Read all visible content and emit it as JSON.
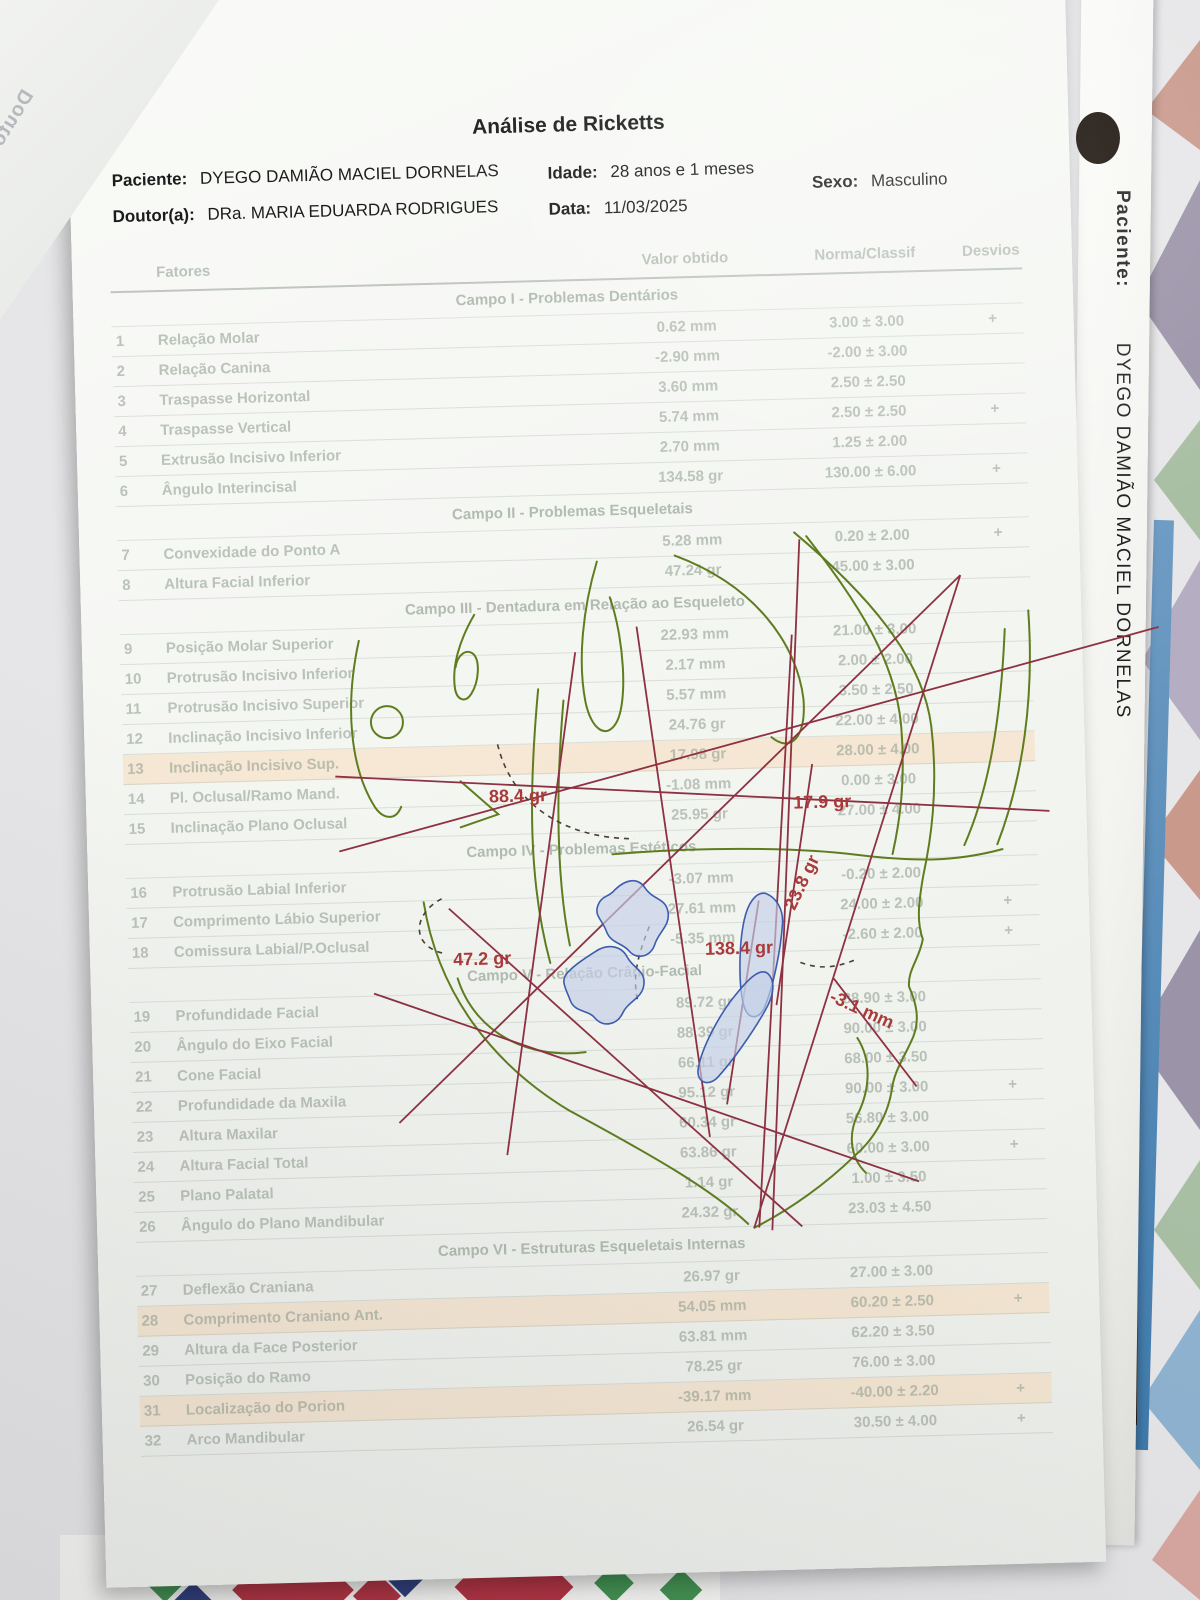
{
  "document": {
    "title": "Análise de Ricketts",
    "patient_label": "Paciente:",
    "patient_name": "DYEGO DAMIÃO MACIEL DORNELAS",
    "doctor_label": "Doutor(a):",
    "doctor_name": "DRa. MARIA EDUARDA RODRIGUES",
    "age_label": "Idade:",
    "age_value": "28 anos e 1 meses",
    "date_label": "Data:",
    "date_value": "11/03/2025",
    "sex_label": "Sexo:",
    "sex_value": "Masculino"
  },
  "table": {
    "columns": [
      "Fatores",
      "Valor obtido",
      "Norma/Classif",
      "Desvios"
    ],
    "sections": [
      {
        "title": "Campo I - Problemas Dentários",
        "rows": [
          {
            "num": "1",
            "factor": "Relação Molar",
            "value": "0.62 mm",
            "norm": "3.00 ± 3.00",
            "dev": "+"
          },
          {
            "num": "2",
            "factor": "Relação Canina",
            "value": "-2.90 mm",
            "norm": "-2.00 ± 3.00",
            "dev": ""
          },
          {
            "num": "3",
            "factor": "Traspasse Horizontal",
            "value": "3.60 mm",
            "norm": "2.50 ± 2.50",
            "dev": ""
          },
          {
            "num": "4",
            "factor": "Traspasse Vertical",
            "value": "5.74 mm",
            "norm": "2.50 ± 2.50",
            "dev": "+"
          },
          {
            "num": "5",
            "factor": "Extrusão Incisivo Inferior",
            "value": "2.70 mm",
            "norm": "1.25 ± 2.00",
            "dev": ""
          },
          {
            "num": "6",
            "factor": "Ângulo Interincisal",
            "value": "134.58 gr",
            "norm": "130.00 ± 6.00",
            "dev": "+"
          }
        ]
      },
      {
        "title": "Campo II - Problemas Esqueletais",
        "rows": [
          {
            "num": "7",
            "factor": "Convexidade do Ponto A",
            "value": "5.28 mm",
            "norm": "0.20 ± 2.00",
            "dev": "+"
          },
          {
            "num": "8",
            "factor": "Altura Facial Inferior",
            "value": "47.24 gr",
            "norm": "45.00 ± 3.00",
            "dev": ""
          }
        ]
      },
      {
        "title": "Campo III - Dentadura em Relação ao Esqueleto",
        "rows": [
          {
            "num": "9",
            "factor": "Posição Molar Superior",
            "value": "22.93 mm",
            "norm": "21.00 ± 3.00",
            "dev": ""
          },
          {
            "num": "10",
            "factor": "Protrusão Incisivo Inferior",
            "value": "2.17 mm",
            "norm": "2.00 ± 2.00",
            "dev": ""
          },
          {
            "num": "11",
            "factor": "Protrusão Incisivo Superior",
            "value": "5.57 mm",
            "norm": "3.50 ± 2.50",
            "dev": ""
          },
          {
            "num": "12",
            "factor": "Inclinação Incisivo Inferior",
            "value": "24.76 gr",
            "norm": "22.00 ± 4.00",
            "dev": ""
          },
          {
            "num": "13",
            "factor": "Inclinação Incisivo Sup.",
            "value": "17.98 gr",
            "norm": "28.00 ± 4.00",
            "dev": "",
            "hl": true
          },
          {
            "num": "14",
            "factor": "Pl. Oclusal/Ramo Mand.",
            "value": "-1.08 mm",
            "norm": "0.00 ± 3.00",
            "dev": ""
          },
          {
            "num": "15",
            "factor": "Inclinação Plano Oclusal",
            "value": "25.95 gr",
            "norm": "27.00 ± 4.00",
            "dev": ""
          }
        ]
      },
      {
        "title": "Campo IV - Problemas Estéticos",
        "rows": [
          {
            "num": "16",
            "factor": "Protrusão Labial Inferior",
            "value": "-3.07 mm",
            "norm": "-0.20 ± 2.00",
            "dev": ""
          },
          {
            "num": "17",
            "factor": "Comprimento Lábio Superior",
            "value": "27.61 mm",
            "norm": "24.00 ± 2.00",
            "dev": "+"
          },
          {
            "num": "18",
            "factor": "Comissura Labial/P.Oclusal",
            "value": "-5.35 mm",
            "norm": "-2.60 ± 2.00",
            "dev": "+"
          }
        ]
      },
      {
        "title": "Campo V - Relação Crânio-Facial",
        "rows": [
          {
            "num": "19",
            "factor": "Profundidade Facial",
            "value": "89.72 gr",
            "norm": "88.90 ± 3.00",
            "dev": ""
          },
          {
            "num": "20",
            "factor": "Ângulo do Eixo Facial",
            "value": "88.39 gr",
            "norm": "90.00 ± 3.00",
            "dev": ""
          },
          {
            "num": "21",
            "factor": "Cone Facial",
            "value": "66.11 gr",
            "norm": "68.00 ± 3.50",
            "dev": ""
          },
          {
            "num": "22",
            "factor": "Profundidade da Maxila",
            "value": "95.12 gr",
            "norm": "90.00 ± 3.00",
            "dev": "+"
          },
          {
            "num": "23",
            "factor": "Altura Maxilar",
            "value": "60.34 gr",
            "norm": "56.80 ± 3.00",
            "dev": ""
          },
          {
            "num": "24",
            "factor": "Altura Facial Total",
            "value": "63.86 gr",
            "norm": "60.00 ± 3.00",
            "dev": "+"
          },
          {
            "num": "25",
            "factor": "Plano Palatal",
            "value": "1.14 gr",
            "norm": "1.00 ± 3.50",
            "dev": ""
          },
          {
            "num": "26",
            "factor": "Ângulo do Plano Mandibular",
            "value": "24.32 gr",
            "norm": "23.03 ± 4.50",
            "dev": ""
          }
        ]
      },
      {
        "title": "Campo VI - Estruturas Esqueletais Internas",
        "rows": [
          {
            "num": "27",
            "factor": "Deflexão Craniana",
            "value": "26.97 gr",
            "norm": "27.00 ± 3.00",
            "dev": ""
          },
          {
            "num": "28",
            "factor": "Comprimento Craniano Ant.",
            "value": "54.05 mm",
            "norm": "60.20 ± 2.50",
            "dev": "+",
            "hl": true
          },
          {
            "num": "29",
            "factor": "Altura da Face Posterior",
            "value": "63.81 mm",
            "norm": "62.20 ± 3.50",
            "dev": ""
          },
          {
            "num": "30",
            "factor": "Posição do Ramo",
            "value": "78.25 gr",
            "norm": "76.00 ± 3.00",
            "dev": ""
          },
          {
            "num": "31",
            "factor": "Localização do Porion",
            "value": "-39.17 mm",
            "norm": "-40.00 ± 2.20",
            "dev": "+",
            "hl": true
          },
          {
            "num": "32",
            "factor": "Arco Mandibular",
            "value": "26.54 gr",
            "norm": "30.50 ± 4.00",
            "dev": "+"
          }
        ]
      }
    ]
  },
  "tracing": {
    "labels": [
      {
        "id": "occlusal-angle",
        "text": "88.4 gr"
      },
      {
        "id": "upper-angle",
        "text": "17.9 gr"
      },
      {
        "id": "incisor-axis-angle",
        "text": "23.8 gr"
      },
      {
        "id": "lower-angle",
        "text": "47.2 gr"
      },
      {
        "id": "interincisal-angle",
        "text": "138.4 gr"
      },
      {
        "id": "linear-measure",
        "text": "-3.1 mm"
      }
    ]
  },
  "side_tab": {
    "patient_label": "Paciente:",
    "patient_name": "DYEGO DAMIÃO MACIEL DORNELAS"
  },
  "under_sheet": {
    "line1": "Paciente: DYE",
    "line2": "Doutor(a): D"
  },
  "colors": {
    "annotation_red": "#a83a3a",
    "tracing_line_red": "#8e3142",
    "tracing_green": "#5f7d1f",
    "tooth_blue": "#3c5cae",
    "highlight_row": "#f8d6b2",
    "pattern_diamond_red": "#b03040",
    "pattern_diamond_green": "#3f8f4f",
    "pattern_diamond_navy": "#2c3b7a",
    "pattern_triangle_salmon": "#c9998c",
    "pattern_triangle_mauve": "#9b93a8",
    "pattern_triangle_blue": "#6f9cc4",
    "pattern_triangle_sage": "#a9bfa4"
  }
}
